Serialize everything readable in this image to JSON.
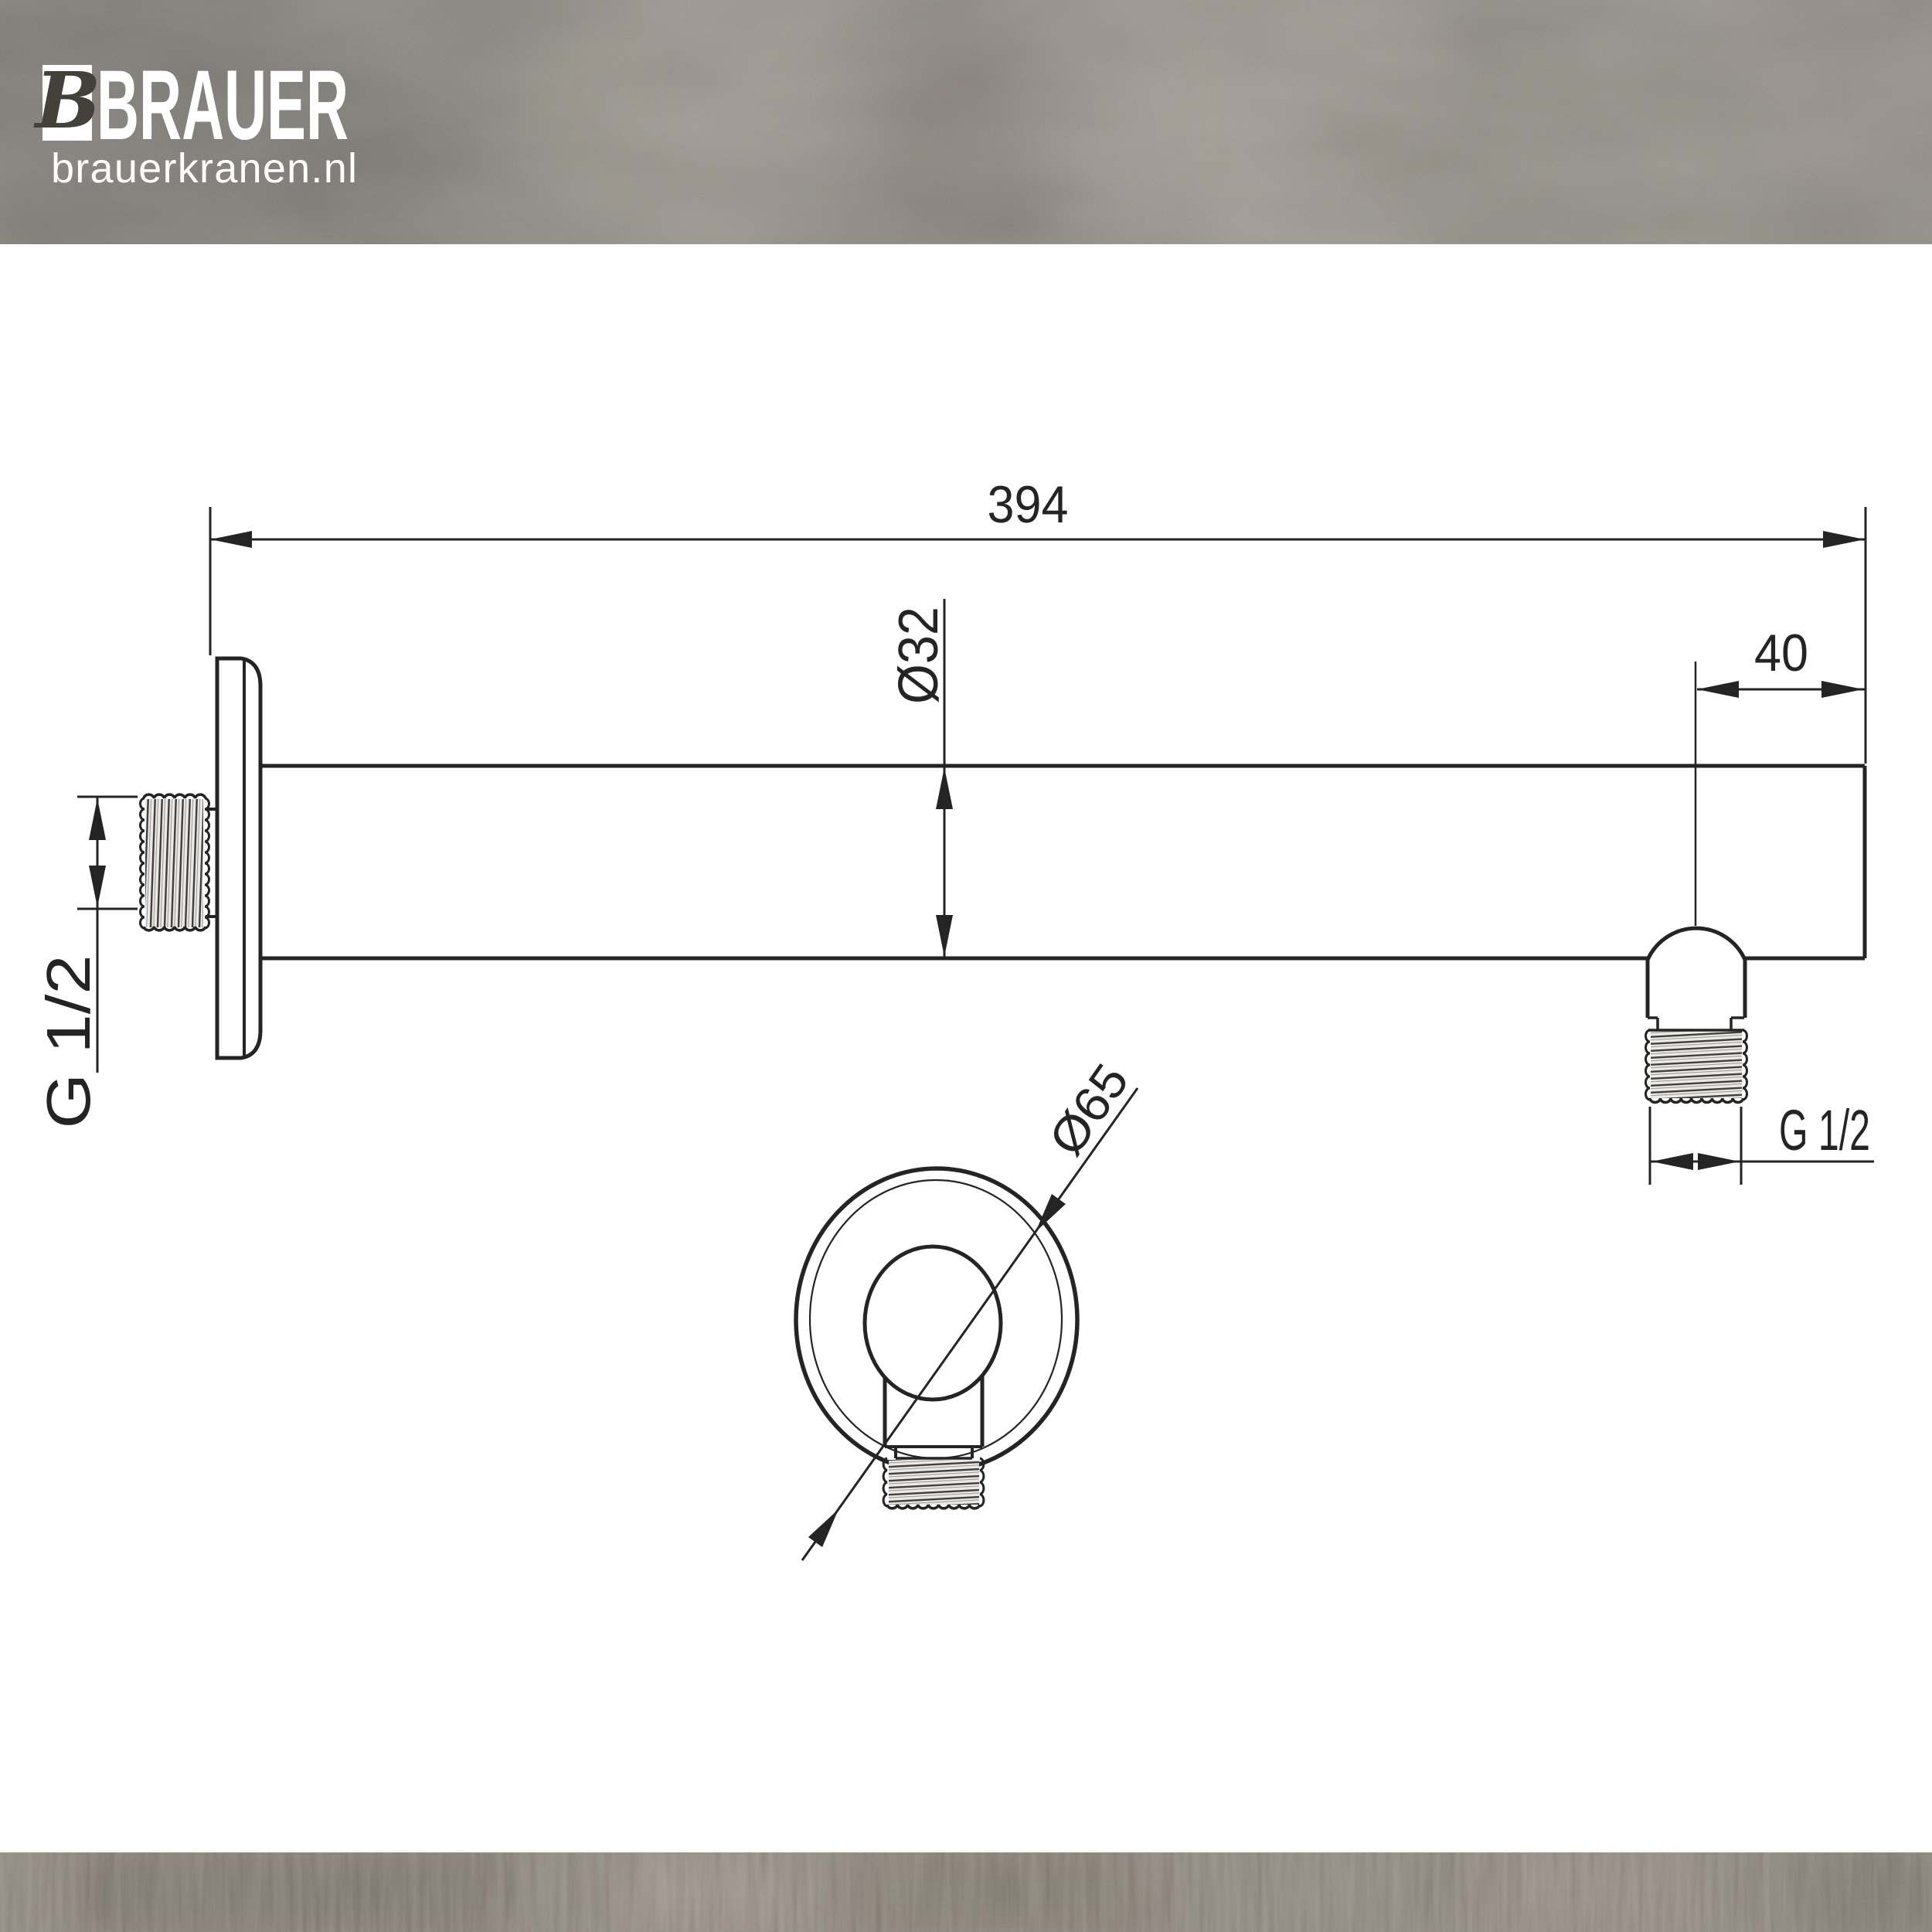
{
  "brand": {
    "monogram": "B",
    "name": "BRAUER",
    "website": "brauerkranen.nl"
  },
  "drawing": {
    "part": "wall-mounted shower arm, side view and wall-flange front view",
    "labels": {
      "arm_length": "394",
      "outlet_offset": "40",
      "tube_diameter": "Ø32",
      "flange_diameter": "Ø65",
      "wall_thread": "G 1/2",
      "outlet_thread": "G 1/2"
    },
    "colors": {
      "line": "#242424",
      "paper": "#ffffff",
      "band_top": "#8a857d",
      "band_bottom": "#8a8077"
    }
  }
}
